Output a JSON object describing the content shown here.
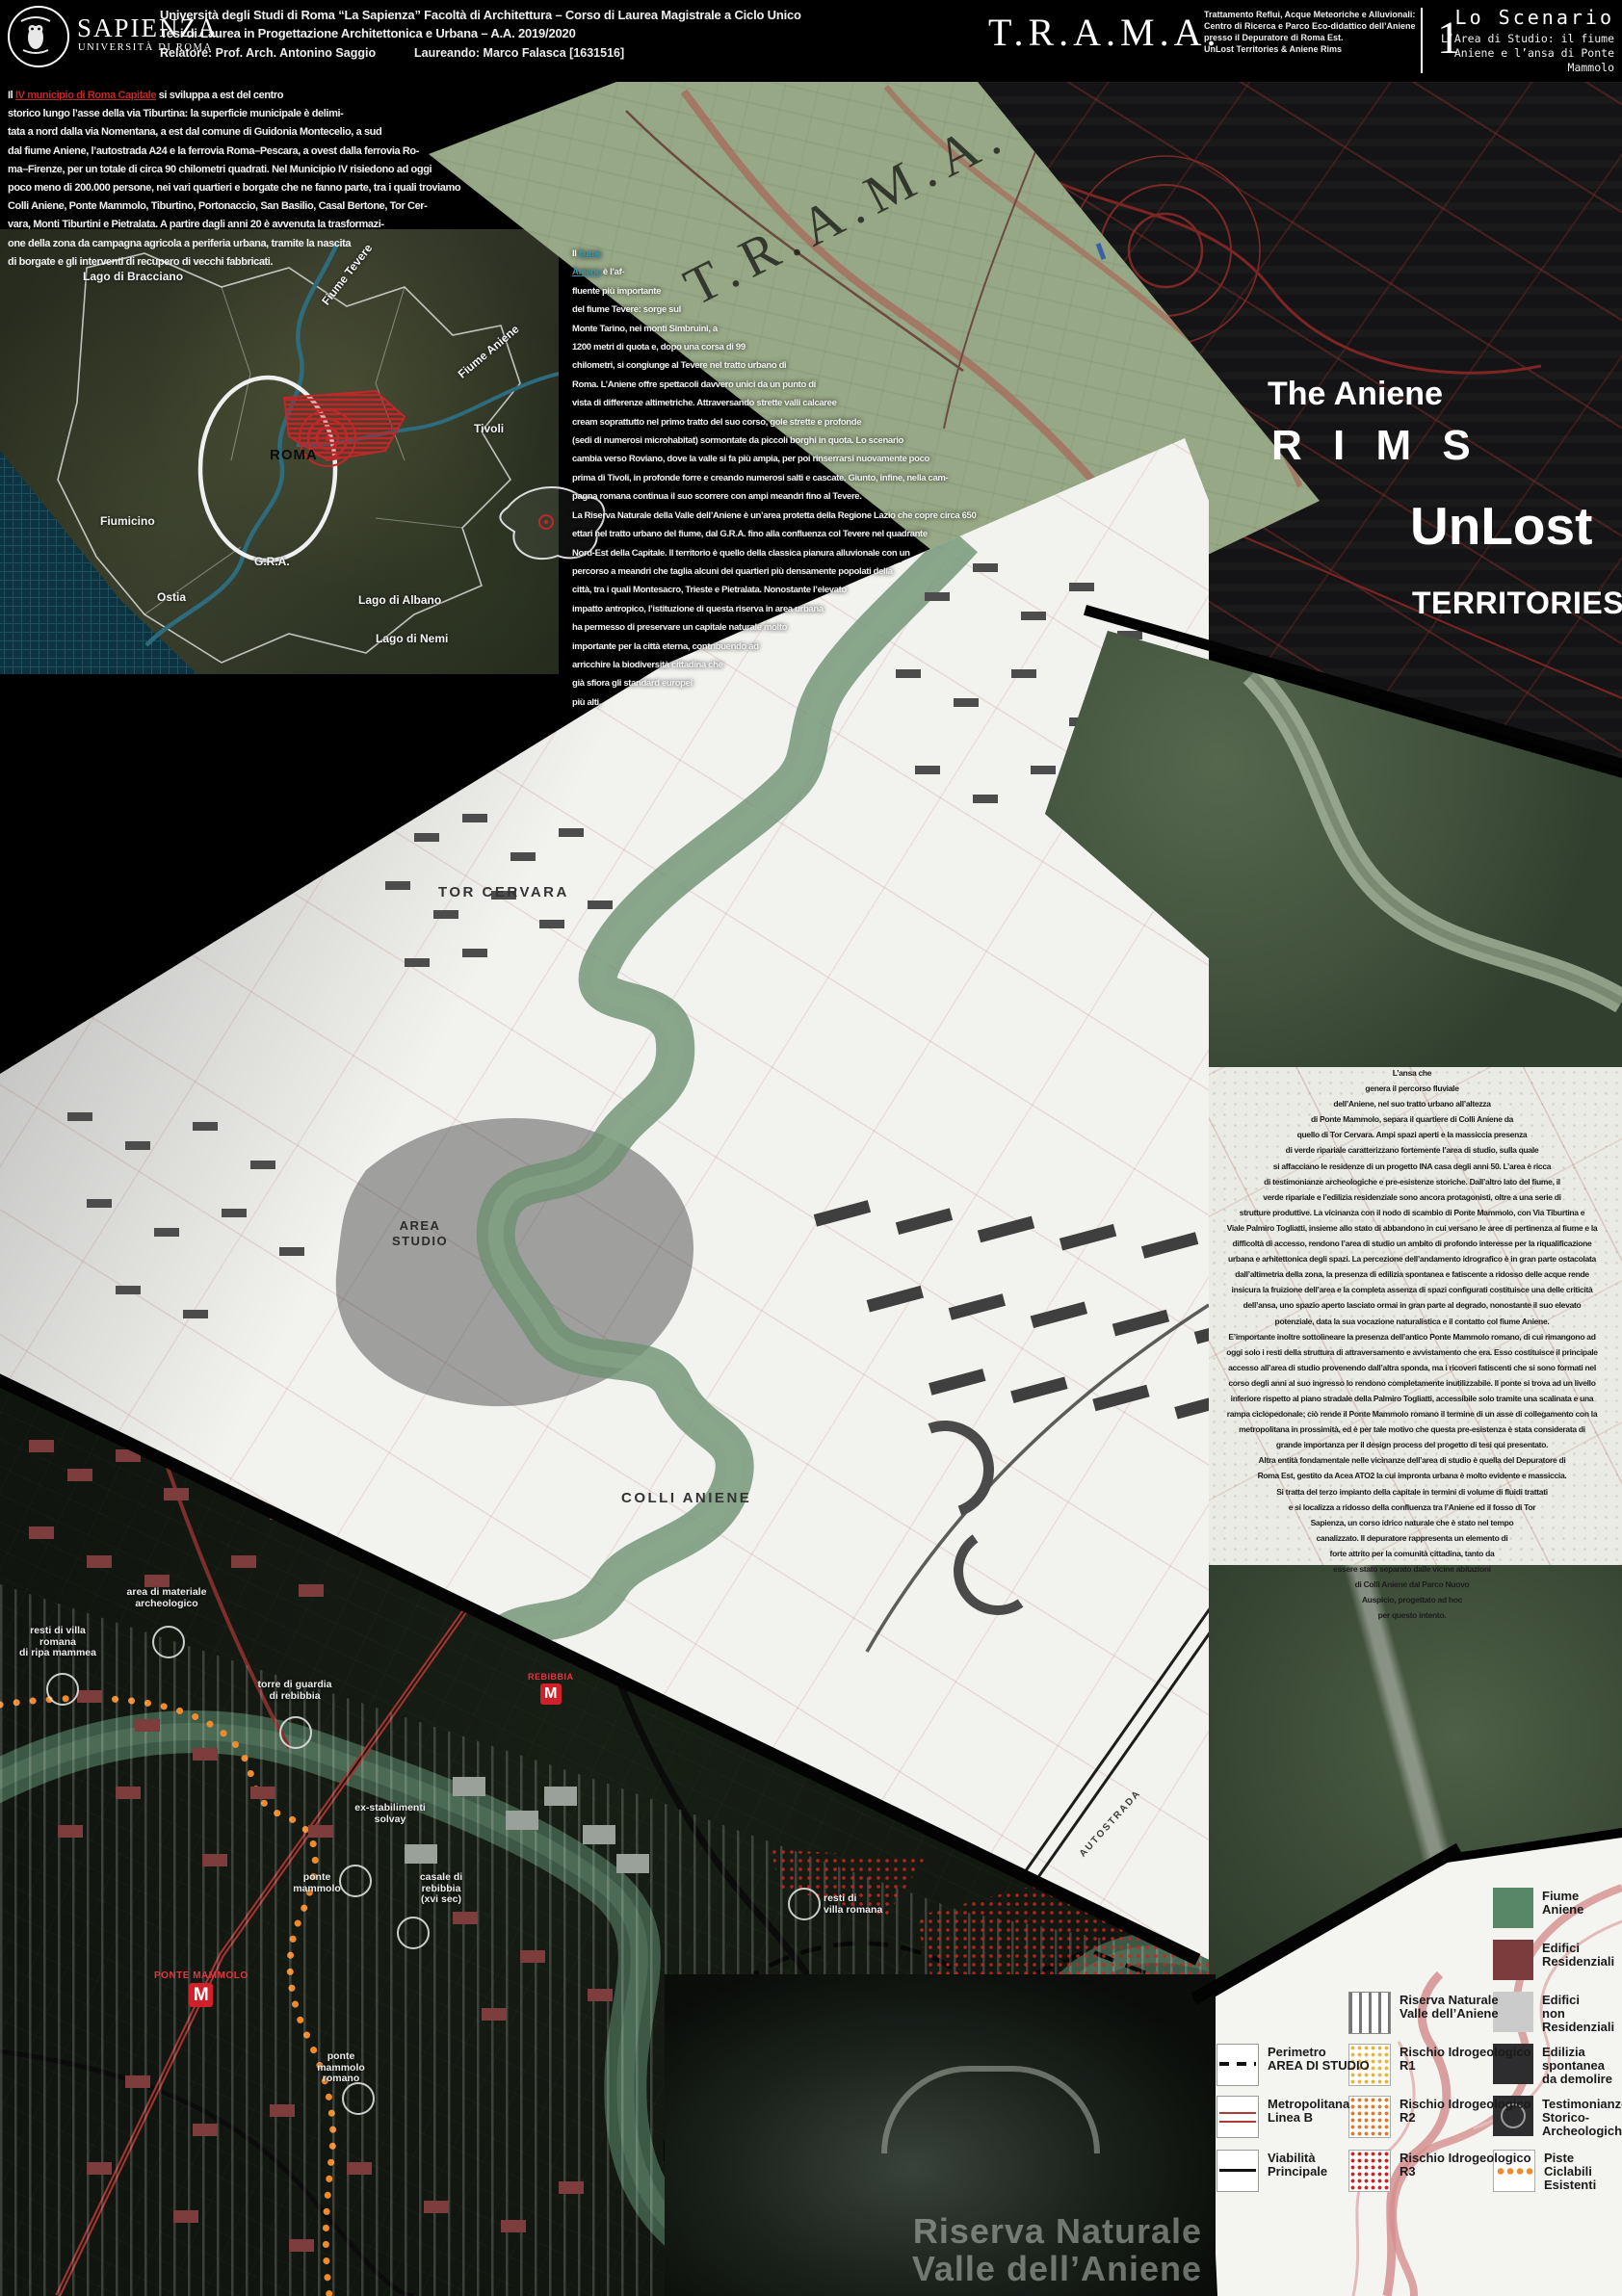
{
  "header": {
    "logo_title": "SAPIENZA",
    "logo_subtitle": "UNIVERSITÀ DI ROMA",
    "university_line1": "Università degli Studi di Roma “La Sapienza” Facoltà di Architettura – Corso di Laurea Magistrale a Ciclo Unico",
    "university_line2": "Tesi di Laurea in Progettazione Architettonica e Urbana – A.A. 2019/2020",
    "relatore": "Relatore: Prof. Arch. Antonino Saggio",
    "laureando": "Laureando: Marco Falasca [1631516]",
    "acronym": "T.R.A.M.A.",
    "project_description": "Trattamento Reflui, Acque Meteoriche e Alluvionali:\nCentro di Ricerca e Parco Eco-didattico dell’Aniene\npresso il Depuratore di Roma Est.\nUnLost Territories & Aniene Rims",
    "panel_number": "1",
    "scenario_title": "Lo Scenario",
    "scenario_subtitle": "L’Area di Studio: il fiume\nAniene e l’ansa di Ponte\nMammolo"
  },
  "intro": {
    "lead": "Il ",
    "highlight": "IV municipio di Roma Capitale",
    "rest": " si sviluppa a est del centro\nstorico lungo l’asse della via Tiburtina: la superficie municipale è delimi-\ntata a nord dalla via Nomentana, a est dal comune di Guidonia Montecelio, a sud\ndal fiume Aniene, l’autostrada A24 e la ferrovia Roma–Pescara, a ovest dalla ferrovia Ro-\nma–Firenze, per un totale di circa 90 chilometri quadrati. Nel Municipio IV risiedono ad oggi\npoco meno di 200.000 persone, nei vari quartieri e borgate che ne fanno parte, tra i quali troviamo\nColli Aniene, Ponte Mammolo, Tiburtino, Portonaccio, San Basilio, Casal Bertone, Tor Cer-\nvara, Monti Tiburtini e Pietralata. A partire dagli anni 20 è avvenuta la trasformazi-\none della zona da campagna agricola a periferia urbana, tramite la nascita\ndi borgate e gli interventi di recupero di vecchi fabbricati."
  },
  "aniene": {
    "lead": "Il ",
    "highlight": "fiume\nAniene",
    "rest": " è l’af-\nfluente più importante\ndel fiume Tevere: sorge sul\nMonte Tarino, nei monti Simbruini, a\n1200 metri di quota e, dopo una corsa di 99\nchilometri, si congiunge al Tevere nel tratto urbano di\nRoma. L’Aniene offre spettacoli davvero unici da un punto di\nvista di differenze altimetriche. Attraversando strette valli calcaree\ncream soprattutto nel primo tratto del suo corso, gole strette e profonde\n(sedi di numerosi microhabitat) sormontate da piccoli borghi in quota. Lo scenario\ncambia verso Roviano, dove la valle si fa più ampia, per poi rinserrarsi nuovamente poco\nprima di Tivoli, in profonde forre e creando numerosi salti e cascate. Giunto, infine, nella cam-\npagna romana continua il suo scorrere con ampi meandri fino al Tevere.\nLa Riserva Naturale della Valle dell’Aniene è un’area protetta della Regione Lazio che copre circa 650\nettari nel tratto urbano del fiume, dal G.R.A. fino alla confluenza col Tevere nel quadrante\nNord-Est della Capitale. Il territorio è quello della classica pianura alluvionale con un\npercorso a meandri che taglia alcuni dei quartieri più densamente popolati della\ncittà, tra i quali Montesacro, Trieste e Pietralata. Nonostante l’elevato\nimpatto antropico, l’istituzione di questa riserva in area urbana\nha permesso di preservare un capitale naturale molto\nimportante per la città eterna, contribuendo ad\narricchire la biodiversità cittadina che\ngià sfiora gli standard europei\npiù alti."
  },
  "ansa": {
    "text": "L’ansa che\ngenera il percorso fluviale\ndell’Aniene, nel suo tratto urbano all’altezza\ndi Ponte Mammolo, separa il quartiere di Colli Aniene da\nquello di Tor Cervara. Ampi spazi aperti e la massiccia presenza\ndi verde ripariale caratterizzano fortemente l’area di studio, sulla quale\nsi affacciano le residenze di un progetto INA casa degli anni 50. L’area è ricca\ndi testimonianze archeologiche e pre-esistenze storiche. Dall’altro lato del fiume, il\nverde ripariale e l’edilizia residenziale sono ancora protagonisti, oltre a una serie di\nstrutture produttive. La vicinanza con il nodo di scambio di Ponte Mammolo, con Via Tiburtina e\nViale Palmiro Togliatti, insieme allo stato di abbandono in cui versano le aree di pertinenza al fiume e la\ndifficoltà di accesso, rendono l’area di studio un ambito di profondo interesse per la riqualificazione\nurbana e arhitettonica degli spazi. La percezione dell’andamento idrografico è in gran parte ostacolata\ndall’altimetria della zona, la presenza di edilizia spontanea e fatiscente a ridosso delle acque rende\ninsicura la fruizione dell’area e la completa assenza di spazi configurati costituisce una delle criticità\ndell’ansa, uno spazio aperto lasciato ormai in gran parte al degrado, nonostante il suo elevato\npotenziale, data la sua vocazione naturalistica e il contatto col fiume Aniene.\nE’importante inoltre sottolineare la presenza dell’antico Ponte Mammolo romano, di cui rimangono ad\noggi solo i resti della struttura di attraversamento e avvistamento che era. Esso costituisce il principale\naccesso all’area di studio provenendo dall’altra sponda, ma i ricoveri fatiscenti che si sono formati nel\ncorso degli anni al suo ingresso lo rendono completamente inutilizzabile. Il ponte si trova ad un livello\ninferiore rispetto al piano stradale della Palmiro Togliatti, accessibile solo tramite una scalinata e una\nrampa ciclopedonale; ciò rende il Ponte Mammolo romano il termine di un asse di collegamento con la\nmetropolitana in prossimità, ed è per tale motivo che questa pre-esistenza è stata considerata di\ngrande importanza per il design process del progetto di tesi qui presentato.\nAltra entità fondamentale nelle vicinanze dell’area di studio è quella del Depuratore di\nRoma Est, gestito da Acea ATO2 la cui impronta urbana è molto evidente e massiccia.\nSi tratta del terzo impianto della capitale in termini di volume di fluidi trattati\ne si localizza a ridosso della confluenza tra l’Aniene ed il fosso di Tor\nSapienza, un corso idrico naturale che è stato nel tempo\ncanalizzato. Il depuratore rappresenta un elemento di\nforte attrito per la comunità cittadina, tanto da\nessere stato separato dalle vicine abitazioni\ndi Colli Aniene dal Parco Nuovo\nAuspicio, progettato ad hoc\nper questo intento."
  },
  "overview_map": {
    "labels": {
      "bracciano": "Lago di Bracciano",
      "fiume_tevere": "Fiume Tevere",
      "fiume_aniene": "Fiume Aniene",
      "tivoli": "Tivoli",
      "roma": "ROMA",
      "gra": "G.R.A.",
      "fiumicino": "Fiumicino",
      "ostia": "Ostia",
      "albano": "Lago di Albano",
      "nemi": "Lago di Nemi"
    }
  },
  "titles": {
    "trama_watermark": "T.R.A.M.A.",
    "aniene": "The Aniene",
    "rims": "R I M S",
    "unlost": "UnLost",
    "territories": "TERRITORIES"
  },
  "topo_map": {
    "labels": {
      "tor_cervara": "TOR CERVARA",
      "area_studio": "AREA\nSTUDIO",
      "colli_aniene": "COLLI ANIENE",
      "autostrada": "AUTOSTRADA"
    }
  },
  "site_map": {
    "poi": {
      "area_materiale": "area di materiale\narcheologico",
      "resti_ripa": "resti di villa\nromana\ndi ripa mammea",
      "torre_guardia": "torre di guardia\ndi rebibbia",
      "ex_solvay": "ex-stabilimenti\nsolvay",
      "casale": "casale di\nrebibbia\n(xvi sec)",
      "ponte_mammolo": "ponte\nmammolo",
      "resti_villa": "resti di\nvilla romana",
      "ponte_romano": "ponte\nmammolo\nromano"
    },
    "metro": {
      "rebibbia": "REBIBBIA",
      "ponte_mammolo": "PONTE MAMMOLO",
      "m": "M"
    }
  },
  "legend": {
    "items": [
      {
        "label": "Fiume\nAniene",
        "type": "green-fill"
      },
      {
        "label": "Edifici\nResidenziali",
        "type": "darkred-fill"
      },
      {
        "label": "Edifici\nnon Residenziali",
        "type": "gray-fill"
      },
      {
        "label": "Edilizia spontanea\nda demolire",
        "type": "dark-fill"
      },
      {
        "label": "Testimonianze\nStorico-\nArcheologiche",
        "type": "dark-circle"
      },
      {
        "label": "Piste Ciclabili\nEsistenti",
        "type": "orange-dotted-line"
      },
      {
        "label": "Riserva Naturale\nValle dell’Aniene",
        "type": "vertical-bars"
      },
      {
        "label": "Rischio Idrogeologico\nR1",
        "type": "yellow-dots"
      },
      {
        "label": "Rischio Idrogeologico\nR2",
        "type": "orange-dots"
      },
      {
        "label": "Rischio Idrogeologico\nR3",
        "type": "red-dots"
      },
      {
        "label": "Perimetro\nAREA DI STUDIO",
        "type": "black-dashed-line"
      },
      {
        "label": "Metropolitana\nLinea B",
        "type": "double-red-line"
      },
      {
        "label": "Viabilità\nPrincipale",
        "type": "black-line"
      }
    ]
  },
  "photo": {
    "caption": "Riserva Naturale\nValle dell’Aniene"
  },
  "colors": {
    "accent_red": "#c0272a",
    "river_teal": "#2d6b7d",
    "historic_green": "#97a886",
    "legend_green": "#588767",
    "legend_red": "#7b3c3e",
    "metro_red": "#d0202a",
    "cycle_orange": "#f08a2a"
  }
}
